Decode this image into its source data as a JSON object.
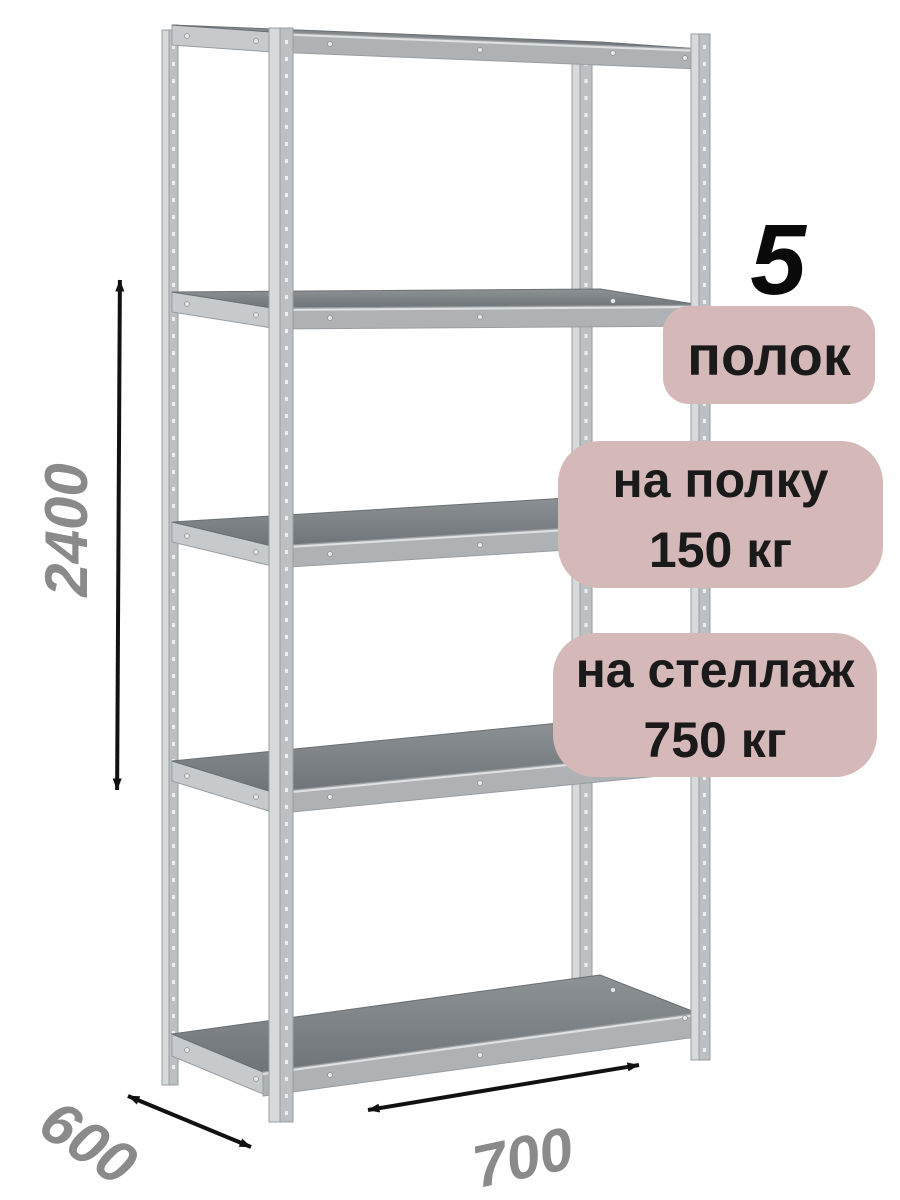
{
  "colors": {
    "background": "#ffffff",
    "badge_bg": "#d5b8b8",
    "badge_text": "#1a1a1a",
    "dimension_text": "#8a8a8a",
    "arrow": "#111111",
    "metal_light": "#d7dadb",
    "metal_mid": "#bcc0c3",
    "metal_beam": "#c6cacd",
    "metal_edge": "#989da1",
    "shelf_top_dark": "#6f7478",
    "shelf_top_light": "#8d9295",
    "shelf_front": "#aeb2b5",
    "rivet": "#e8eaeb",
    "hole": "#eceeef"
  },
  "annotations": {
    "shelf_count": {
      "number": "5",
      "label": "полок"
    },
    "shelf_load": {
      "line1": "на полку",
      "line2": "150 кг"
    },
    "rack_load": {
      "line1": "на стеллаж",
      "line2": "750 кг"
    }
  },
  "dimensions": {
    "height": "2400",
    "depth": "600",
    "width": "700"
  }
}
